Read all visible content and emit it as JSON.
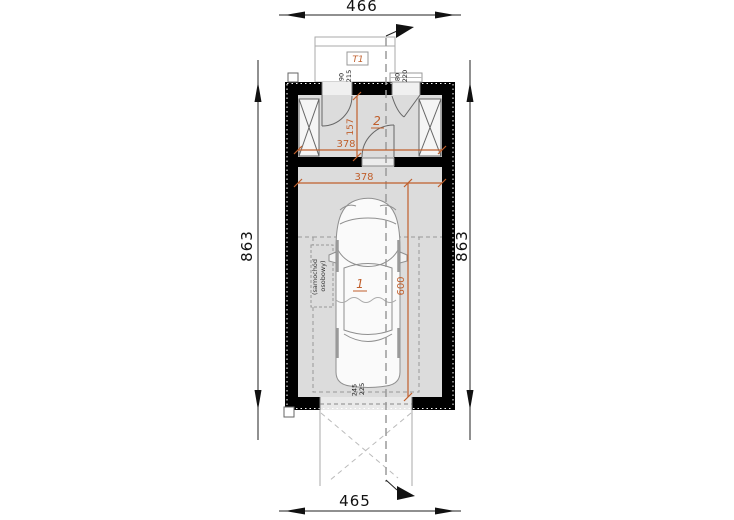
{
  "drawing": {
    "type_label": "garage floor plan",
    "outer_dimensions": {
      "top": "466",
      "bottom": "465",
      "left": "863",
      "right": "863"
    },
    "interior_dimensions": {
      "vestibule_width": "378",
      "vestibule_depth": "157",
      "garage_width": "378",
      "parking_length": "600"
    },
    "openings": {
      "entry_door": {
        "width": "90",
        "height": "215"
      },
      "side_door": {
        "width": "80",
        "height": "220"
      },
      "garage_gate": {
        "width": "245",
        "height": "225"
      }
    },
    "rooms": {
      "garage_number": "1",
      "vestibule_number": "2"
    },
    "terrace_label": "T1",
    "car_annotation": {
      "line1": "(samochód",
      "line2": "osobowy)"
    },
    "colors": {
      "wall": "#000000",
      "floor": "#dcdcdc",
      "accent": "#c05f2c",
      "axis": "#9a9a9a",
      "car_line": "#8f8f8f"
    }
  }
}
